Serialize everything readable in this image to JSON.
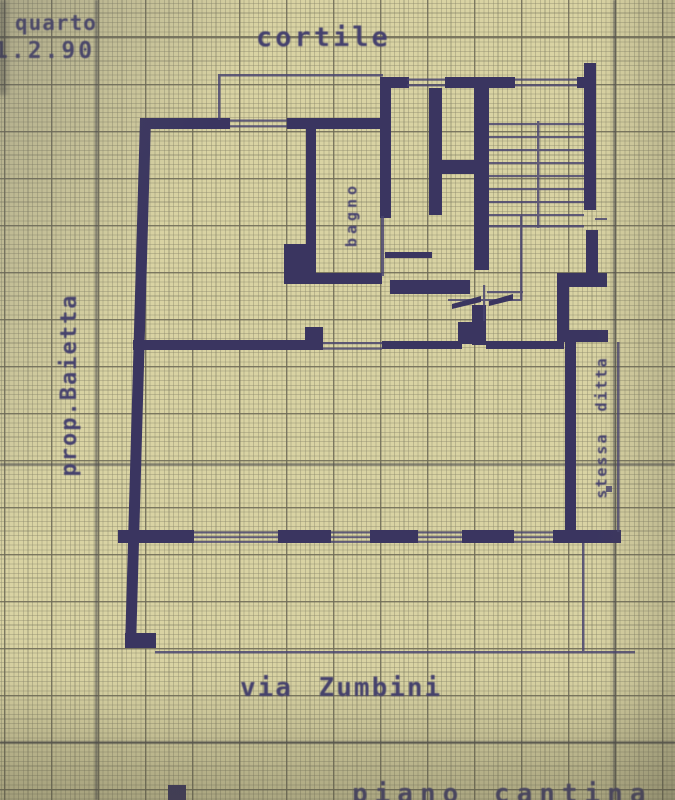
{
  "sheet": {
    "type": "photographed floor plan on millimeter graph paper",
    "notes": {
      "floor": "quarto",
      "date": "1.2.90"
    },
    "labels": {
      "courtyard": "cortile",
      "left_boundary": "prop.Baietta",
      "bathroom": "bagno",
      "right_boundary": "stessa ditta",
      "street": "via Zumbini",
      "bottom_partial": "piano cantina"
    },
    "colors": {
      "paper": "#d9d3a3",
      "ink": "#3a3560",
      "thin_ink": "#474370",
      "text": "#45416e",
      "grid_major": "#6c6955"
    }
  }
}
